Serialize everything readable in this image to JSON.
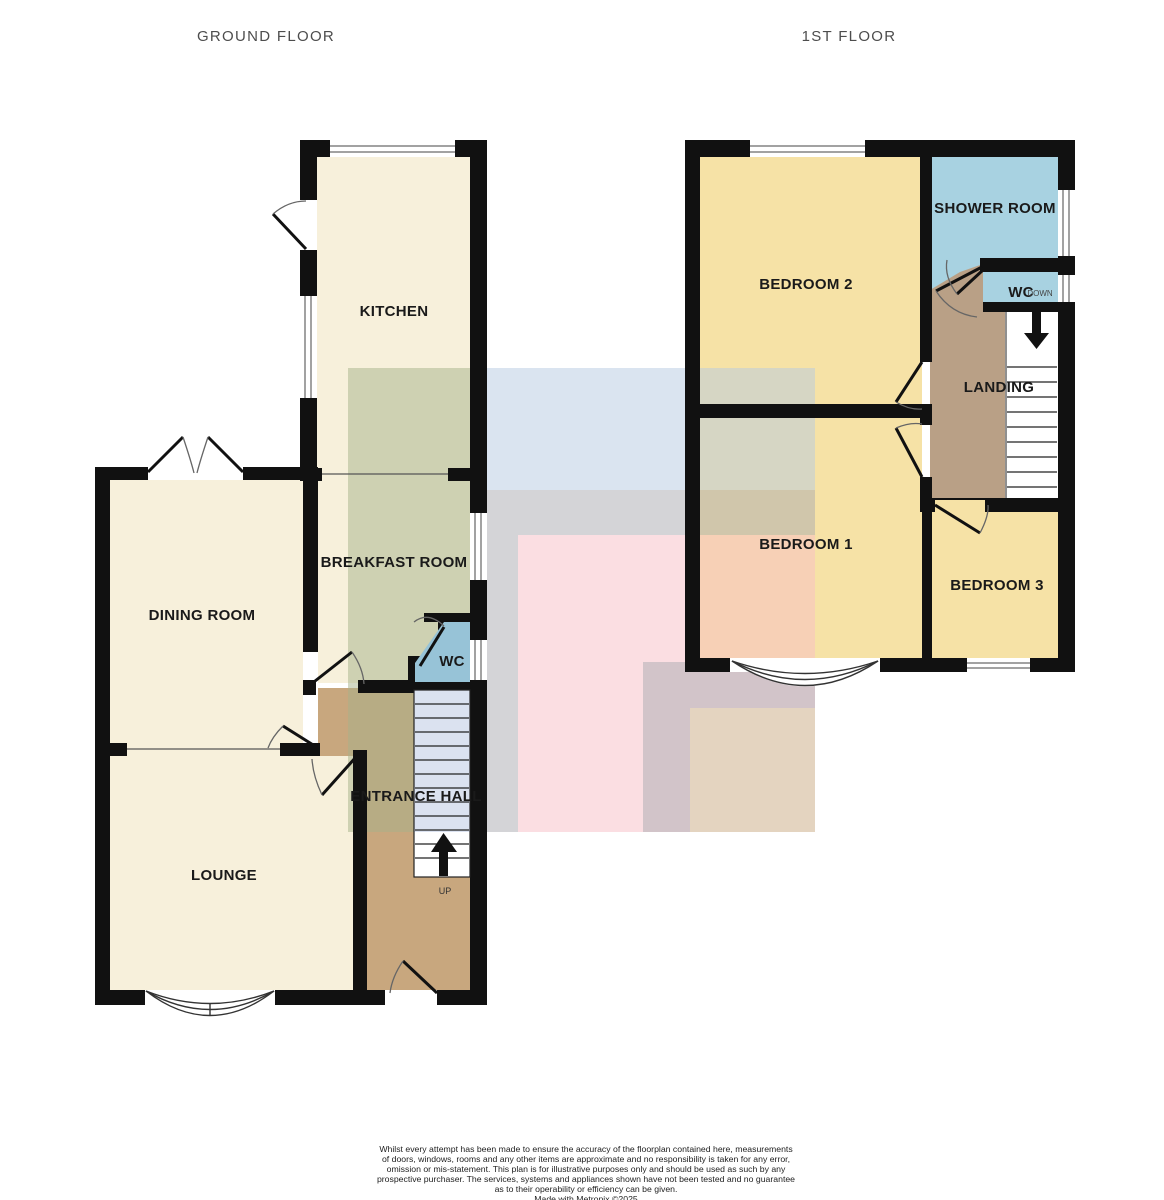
{
  "headers": {
    "ground_floor": "GROUND FLOOR",
    "first_floor": "1ST FLOOR"
  },
  "ground_floor": {
    "rooms": {
      "kitchen": "KITCHEN",
      "breakfast_room": "BREAKFAST ROOM",
      "dining_room": "DINING ROOM",
      "wc": "WC",
      "entrance_hall": "ENTRANCE HALL",
      "lounge": "LOUNGE"
    },
    "stairs_label": "UP"
  },
  "first_floor": {
    "rooms": {
      "bedroom_2": "BEDROOM 2",
      "shower_room": "SHOWER ROOM",
      "wc": "WC",
      "landing": "LANDING",
      "bedroom_1": "BEDROOM 1",
      "bedroom_3": "BEDROOM 3"
    },
    "stairs_label": "DOWN"
  },
  "footer": {
    "disclaimer_lines": [
      "Whilst every attempt has been made to ensure the accuracy of the floorplan contained here, measurements",
      "of doors, windows, rooms and any other items are approximate and no responsibility is taken for any error,",
      "omission or mis-statement. This plan is for illustrative purposes only and should be used as such by any",
      "prospective purchaser. The services, systems and appliances shown have not been tested and no guarantee",
      "as to their operability or efficiency can be given.",
      "Made with Metropix ©2025"
    ]
  },
  "colors": {
    "wall": "#111111",
    "room_cream": "#F7F0DB",
    "room_yellow": "#F6E2A6",
    "hall_brown": "#C8A77E",
    "landing_brown": "#B9A086",
    "shower_blue": "#A8D2E1",
    "wc_blue": "#97C3D7",
    "stair_tread_blue": "#DBE2F0",
    "overlay_green": "rgba(165,177,137,0.5)",
    "overlay_blue": "rgba(181,201,225,0.5)",
    "overlay_gray": "rgba(169,169,175,0.5)",
    "overlay_pink": "rgba(247,189,197,0.5)",
    "overlay_cream": "rgba(245,227,183,0.5)"
  }
}
